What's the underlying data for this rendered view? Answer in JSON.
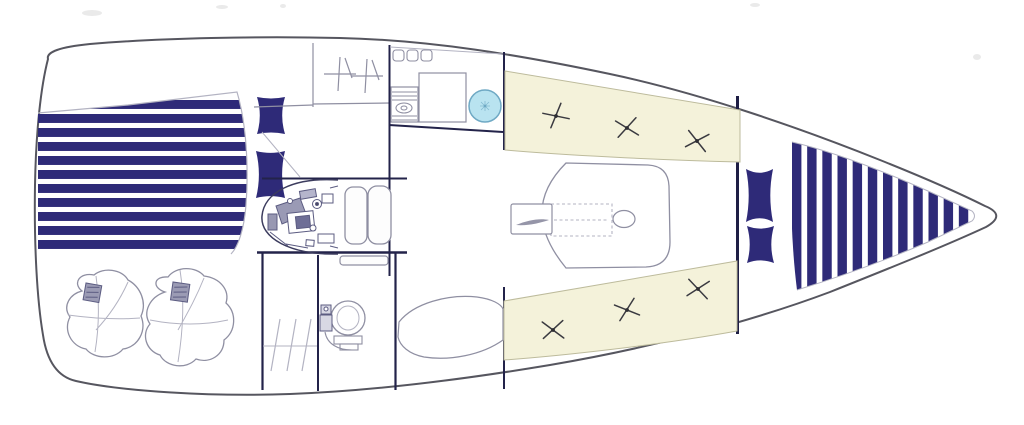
{
  "meta": {
    "title": "Sailboat interior deck plan (top view line drawing)",
    "type": "boat-floor-plan"
  },
  "palette": {
    "background": "#ffffff",
    "navy": "#2e2a78",
    "navy_deep": "#23234a",
    "bulkhead": "#1e1e45",
    "hull_line": "#56565f",
    "line": "#8f8fa2",
    "line_light": "#b3b3c2",
    "cream": "#f4f2da",
    "cream_edge": "#bdbb9c",
    "sink_fill": "#b9e3f0",
    "sink_edge": "#6fa9c4",
    "engine_line": "#5c5c82",
    "engine_fill": "#9a9ab5",
    "tuft": "#3a3a40",
    "smudge": "#d9d9d9"
  },
  "aft_berth": {
    "stripe_count": 11,
    "y_start": 100,
    "y_end": 254,
    "x_left": 36,
    "x_right": 252
  },
  "aft_pillows": [
    [
      257,
      97,
      28,
      37,
      0.08
    ],
    [
      256,
      151,
      29,
      47,
      0.08
    ]
  ],
  "bow_pillows": [
    [
      746,
      169,
      27,
      53,
      0.14
    ],
    [
      747,
      226,
      27,
      37,
      0.14
    ]
  ],
  "v_berth": {
    "stripe_count": 12,
    "x_start": 792,
    "x_end": 974,
    "y_top": 132,
    "y_bottom": 298
  },
  "galley": {
    "locker_count": 3,
    "locker_x": [
      393,
      407,
      421
    ],
    "locker_y": 50,
    "stove_line_ys": [
      92,
      96,
      100,
      116,
      120
    ]
  },
  "head": {
    "hatch_line_x": [
      274,
      290,
      305
    ]
  },
  "settees": {
    "port_tufts": [
      [
        556,
        116,
        -15
      ],
      [
        627,
        128,
        5
      ],
      [
        697,
        141,
        25
      ]
    ],
    "starboard_tufts": [
      [
        553,
        330,
        10
      ],
      [
        627,
        310,
        -5
      ],
      [
        698,
        289,
        20
      ]
    ]
  }
}
